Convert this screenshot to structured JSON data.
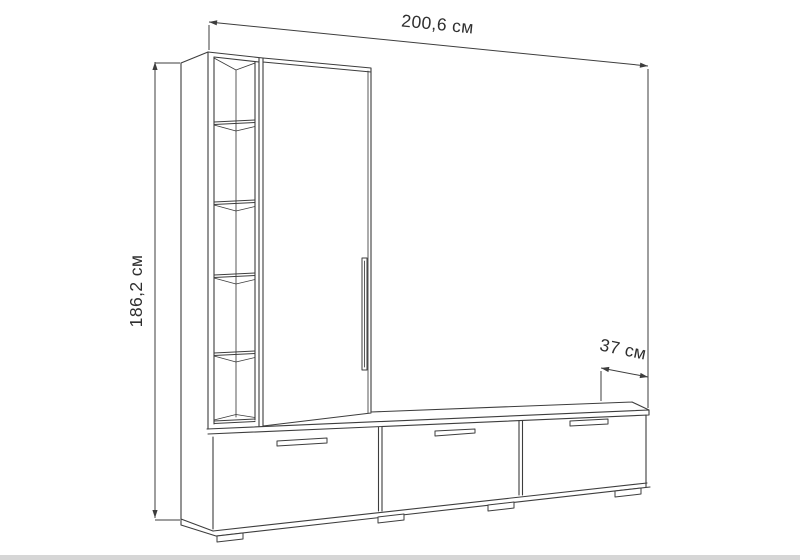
{
  "diagram": {
    "kind": "furniture-dimension-drawing",
    "style": "black line art on white"
  },
  "dimensions": {
    "width": {
      "label": "200,6 см",
      "value_cm": 200.6,
      "orientation": "top, slanted along top edge"
    },
    "height": {
      "label": "186,2 см",
      "value_cm": 186.2,
      "orientation": "left, rotated vertical"
    },
    "depth": {
      "label": "37 см",
      "value_cm": 37,
      "orientation": "right, slanted along depth"
    }
  },
  "structure": {
    "open_shelf_compartments": 5,
    "shelf_count": 4,
    "wardrobe_doors": 1,
    "wardrobe_door_handles": 1,
    "tv_stand_doors": 3,
    "tv_stand_handles": 3,
    "feet": 4
  },
  "colors": {
    "line": "#3d3d3d",
    "text": "#2f2f2f",
    "background": "#ffffff",
    "floor_shadow": "#d6d6d6"
  }
}
